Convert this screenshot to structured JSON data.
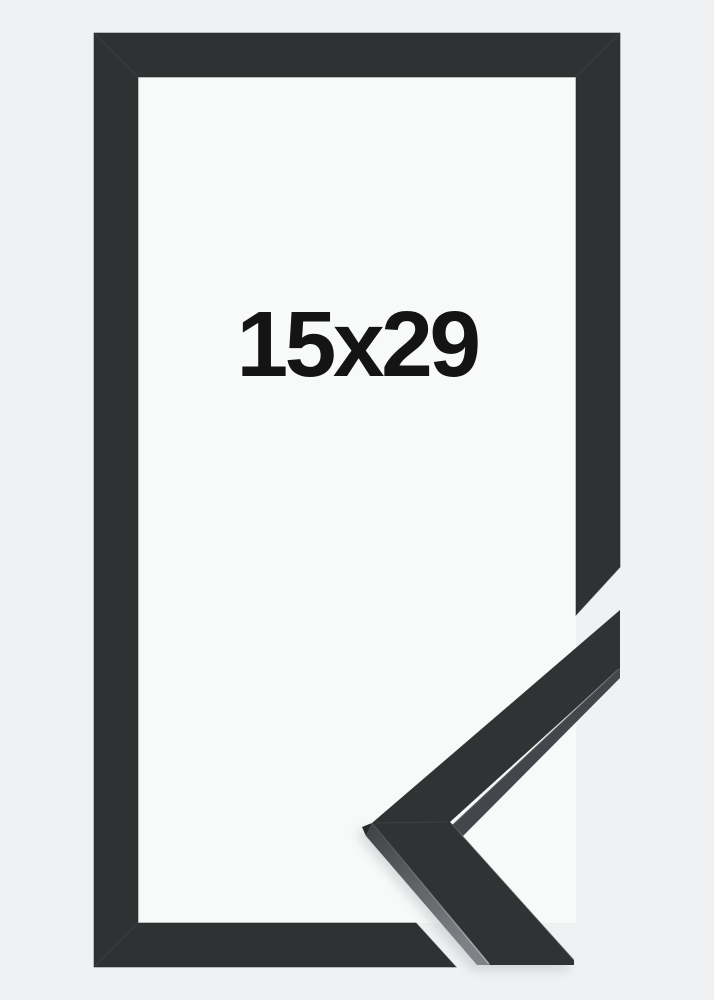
{
  "product": {
    "size_label": "15x29"
  },
  "colors": {
    "page_background": "#eff1f2",
    "frame_opening": "#f8f9f9",
    "moulding": "#2f3133",
    "moulding_outline": "#232527",
    "miter_seam": "#3d4043",
    "corner_top_face": "#303234",
    "corner_lip": "#43464a",
    "corner_side_dark": "#3e4144",
    "corner_side_light": "#7e8286",
    "corner_apex_facet": "#26282b",
    "label_text": "#141414"
  }
}
